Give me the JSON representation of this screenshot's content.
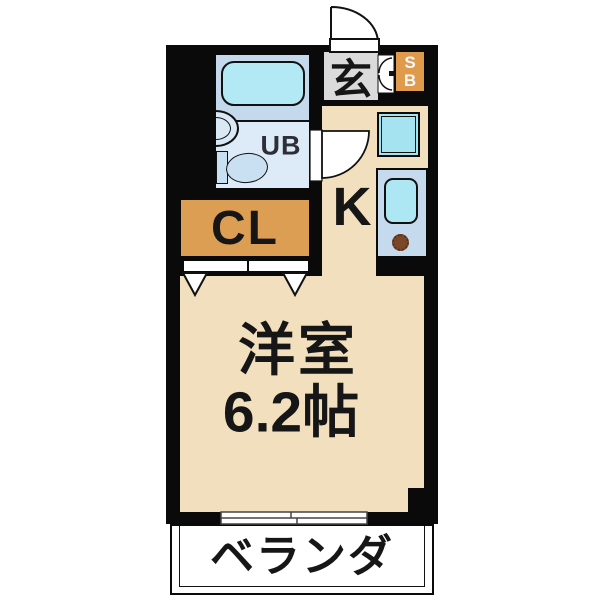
{
  "labels": {
    "entrance": "玄",
    "shoebox_s": "S",
    "shoebox_b": "B",
    "unit_bath": "UB",
    "kitchen": "K",
    "closet": "CL",
    "western_room": "洋室",
    "western_room_size": "6.2帖",
    "veranda": "ベランダ"
  },
  "colors": {
    "wall": "#0a0a0a",
    "floor_beige": "#f1dfbe",
    "closet_orange": "#dc9e52",
    "shoebox_orange": "#e09a4c",
    "entrance_gray": "#dbdbdb",
    "bath_floor": "#dcebf7",
    "bath_tub_zone": "#c5d9ec",
    "bathtub_cyan": "#b3e9f4",
    "window_cyan": "#a5e3f1",
    "sink_cyan": "#ace7f3",
    "counter_blue": "#c6daee",
    "toilet_blue": "#c9dff2",
    "burner_brown": "#7a4728"
  }
}
